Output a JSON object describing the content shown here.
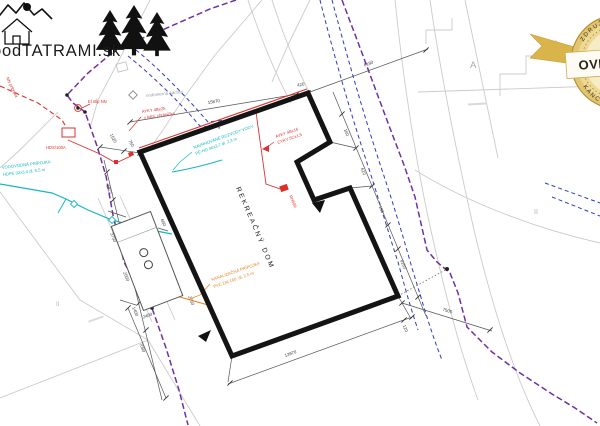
{
  "colors": {
    "boundary_purple": "#7030a0",
    "utility_blue": "#2d3bc0",
    "water_cyan": "#17b8c4",
    "electric_red": "#d9322e",
    "sewer_orange": "#e2801f",
    "building_black": "#141414",
    "parcel_gray": "#cbcbcb",
    "badge_gold": "#d9b44a",
    "badge_cream": "#f6ecc8"
  },
  "logo": {
    "text": "podTATRAMI.sk"
  },
  "badge": {
    "center_text": "OVERENÉ",
    "arc_top": "ZDRUŽENIE",
    "arc_bottom": "KANCELÁRIÍ"
  },
  "plan": {
    "building_label": "REKREAČNÝ DOM",
    "labels": {
      "water_meter_shaft": "vodomerná šachta",
      "electric_pole": "El stĺp NN",
      "service_box": "HDS/100A",
      "meter_box": "RE 1E/2PA",
      "switch_box": "RH50A",
      "edge_cable": "NN prípojka",
      "parcel_a": "A",
      "parcel_ii_right": "II",
      "parcel_ii_left": "II"
    },
    "notes": {
      "water_connection": [
        "VODOVODNÁ PRÍPOJKA",
        "HDPE 32x3,0 dl. 5,5 m"
      ],
      "water_branch": [
        "NAVRHOVANÉ ROZVODY VODY",
        "PE-HD 40x3,7 dl. 2,3 m"
      ],
      "sewer_connection": [
        "KANALIZAČNÁ PRÍPOJKA",
        "PVC DN 160, dl. 2,5 m"
      ],
      "electric_cable_1": [
        "AYKY 4Bx25",
        "v kábl. chráničke"
      ],
      "electric_cable_2": [
        "AYKY 4Bx16",
        "CYKY 5Cx1,5"
      ]
    },
    "dimensions": [
      {
        "t": "15870"
      },
      {
        "t": "420"
      },
      {
        "t": "6180"
      },
      {
        "t": "1520"
      },
      {
        "t": "750"
      },
      {
        "t": "160"
      },
      {
        "t": "610"
      },
      {
        "t": "160"
      },
      {
        "t": "9160"
      },
      {
        "t": "7500"
      },
      {
        "t": "120"
      },
      {
        "t": "13970"
      },
      {
        "t": "5827"
      },
      {
        "t": "3750"
      },
      {
        "t": "2050"
      },
      {
        "t": "1400"
      },
      {
        "t": "2400"
      },
      {
        "t": "650"
      },
      {
        "t": "2050"
      },
      {
        "t": "7080"
      }
    ]
  }
}
